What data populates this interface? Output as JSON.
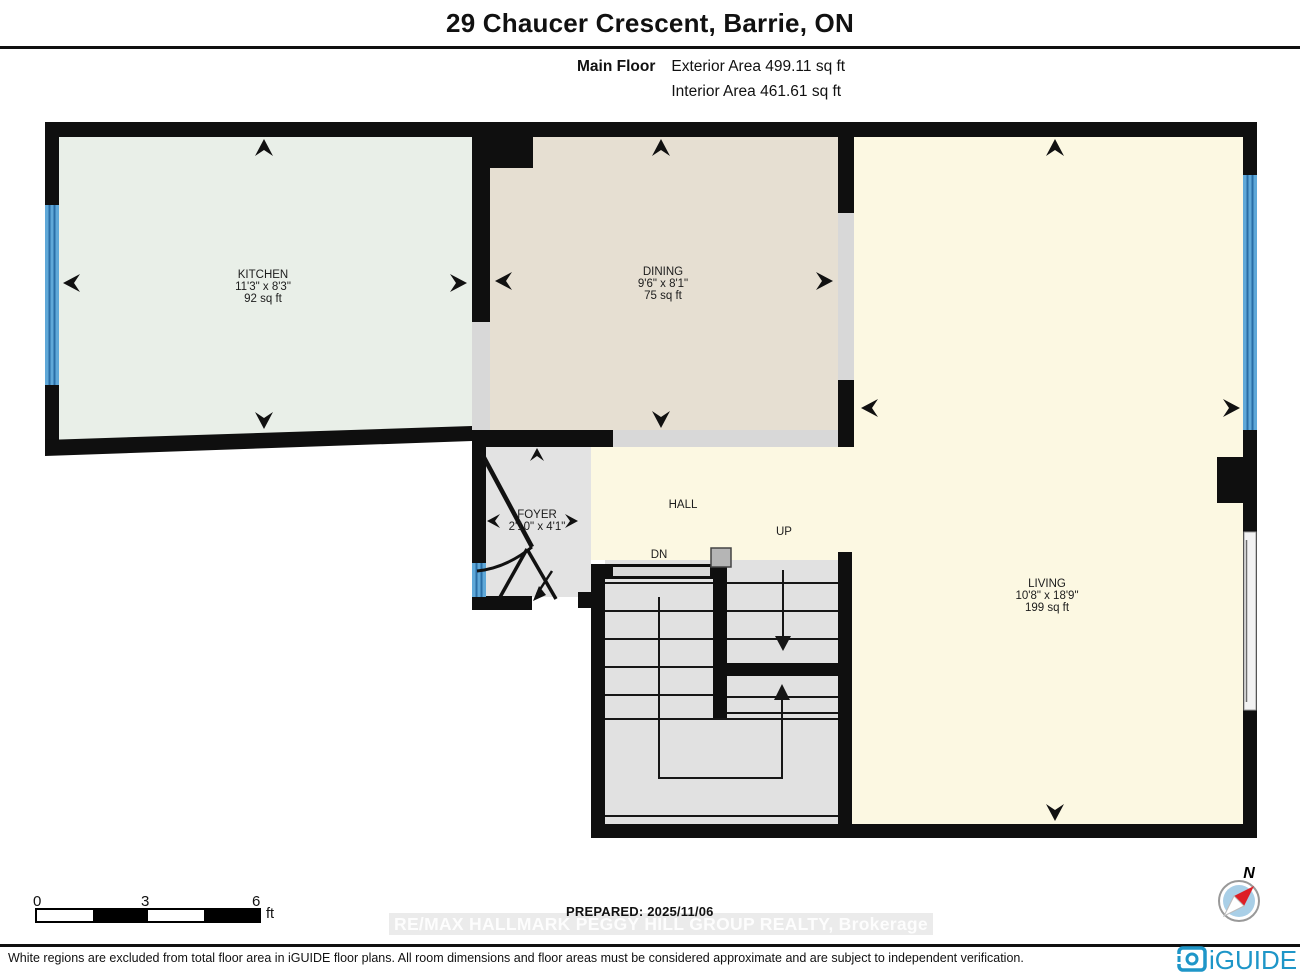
{
  "header": {
    "title": "29 Chaucer Crescent, Barrie, ON",
    "floor_label": "Main Floor",
    "exterior_area": "Exterior Area 499.11 sq ft",
    "interior_area": "Interior Area 461.61 sq ft"
  },
  "rooms": {
    "kitchen": {
      "name": "KITCHEN",
      "dimensions": "11'3\" x 8'3\"",
      "area": "92 sq ft"
    },
    "dining": {
      "name": "DINING",
      "dimensions": "9'6\" x 8'1\"",
      "area": "75 sq ft"
    },
    "living": {
      "name": "LIVING",
      "dimensions": "10'8\" x 18'9\"",
      "area": "199 sq ft"
    },
    "foyer": {
      "name": "FOYER",
      "dimensions": "2'10\" x 4'1\""
    },
    "hall": {
      "name": "HALL"
    },
    "stairs": {
      "up": "UP",
      "down": "DN"
    }
  },
  "scale_bar": {
    "ticks": [
      "0",
      "3",
      "6"
    ],
    "unit": "ft"
  },
  "prepared_label": "PREPARED: 2025/11/06",
  "watermark": "RE/MAX HALLMARK PEGGY HILL GROUP REALTY, Brokerage",
  "compass": {
    "north": "N"
  },
  "branding": {
    "logo_text": "iGUIDE"
  },
  "footer": {
    "disclaimer": "White regions are excluded from total floor area in iGUIDE floor plans. All room dimensions and floor areas must be considered approximate and are subject to independent verification."
  },
  "colors": {
    "wall": "#0f0f0f",
    "kitchen_floor": "#e9efe8",
    "dining_floor": "#e6dfd2",
    "living_floor": "#fcf8e2",
    "foyer_floor": "#e3e3e3",
    "opening_gray": "#d8d8d8",
    "window_blue": "#5fa8d8",
    "iguide_blue": "#1e96c8",
    "compass_red": "#dd1f26"
  }
}
